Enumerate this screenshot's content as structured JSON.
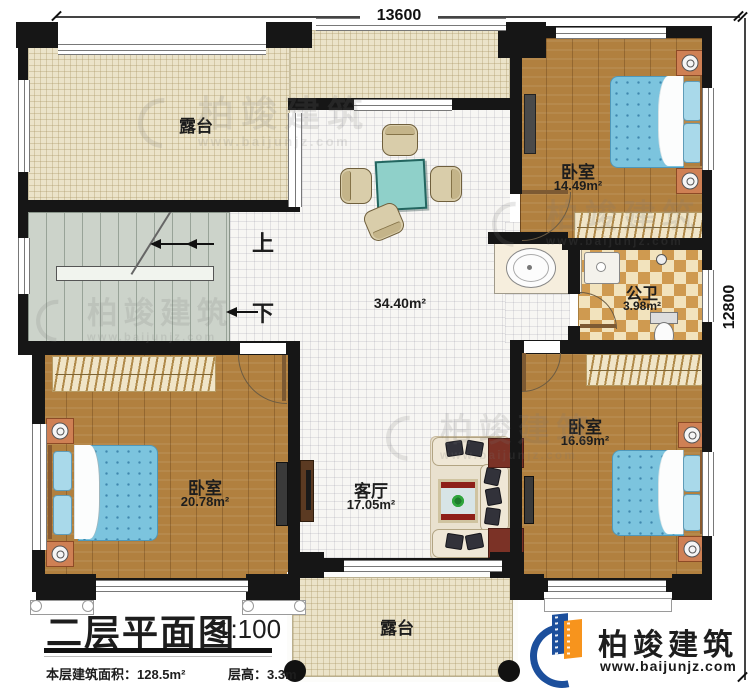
{
  "dimensions": {
    "top": "13600",
    "right": "12800"
  },
  "stairs": {
    "up_label": "上",
    "down_label": "下"
  },
  "rooms": {
    "terrace_top": {
      "label": "露台"
    },
    "hall": {
      "area": "34.40m²"
    },
    "bedroom_top_right": {
      "label": "卧室",
      "area": "14.49m²"
    },
    "bathroom": {
      "label": "公卫",
      "area": "3.98m²"
    },
    "bedroom_bottom_left": {
      "label": "卧室",
      "area": "20.78m²"
    },
    "living_room": {
      "label": "客厅",
      "area": "17.05m²"
    },
    "bedroom_bottom_right": {
      "label": "卧室",
      "area": "16.69m²"
    },
    "terrace_bottom": {
      "label": "露台"
    }
  },
  "title_block": {
    "title": "二层平面图",
    "scale": "1:100",
    "floor_area": "本层建筑面积：128.5m²",
    "floor_height": "层高：3.3m"
  },
  "brand": {
    "name": "柏竣建筑",
    "website": "www.baijunjz.com"
  },
  "watermark": {
    "text": "柏竣建筑",
    "website": "www.baijunjz.com"
  },
  "colors": {
    "wall": "#161616",
    "wood_floor": "#b1803f",
    "terrace_floor": "#ebe3c9",
    "stair_floor": "#ccd3ca",
    "tile_tan": "#cf9a50",
    "tile_cream": "#f2e3bd",
    "bed_blue": "#7cc4de",
    "table_teal": "#8fd0c9",
    "logo_blue": "#1c4f9c",
    "logo_orange": "#f7941d"
  }
}
